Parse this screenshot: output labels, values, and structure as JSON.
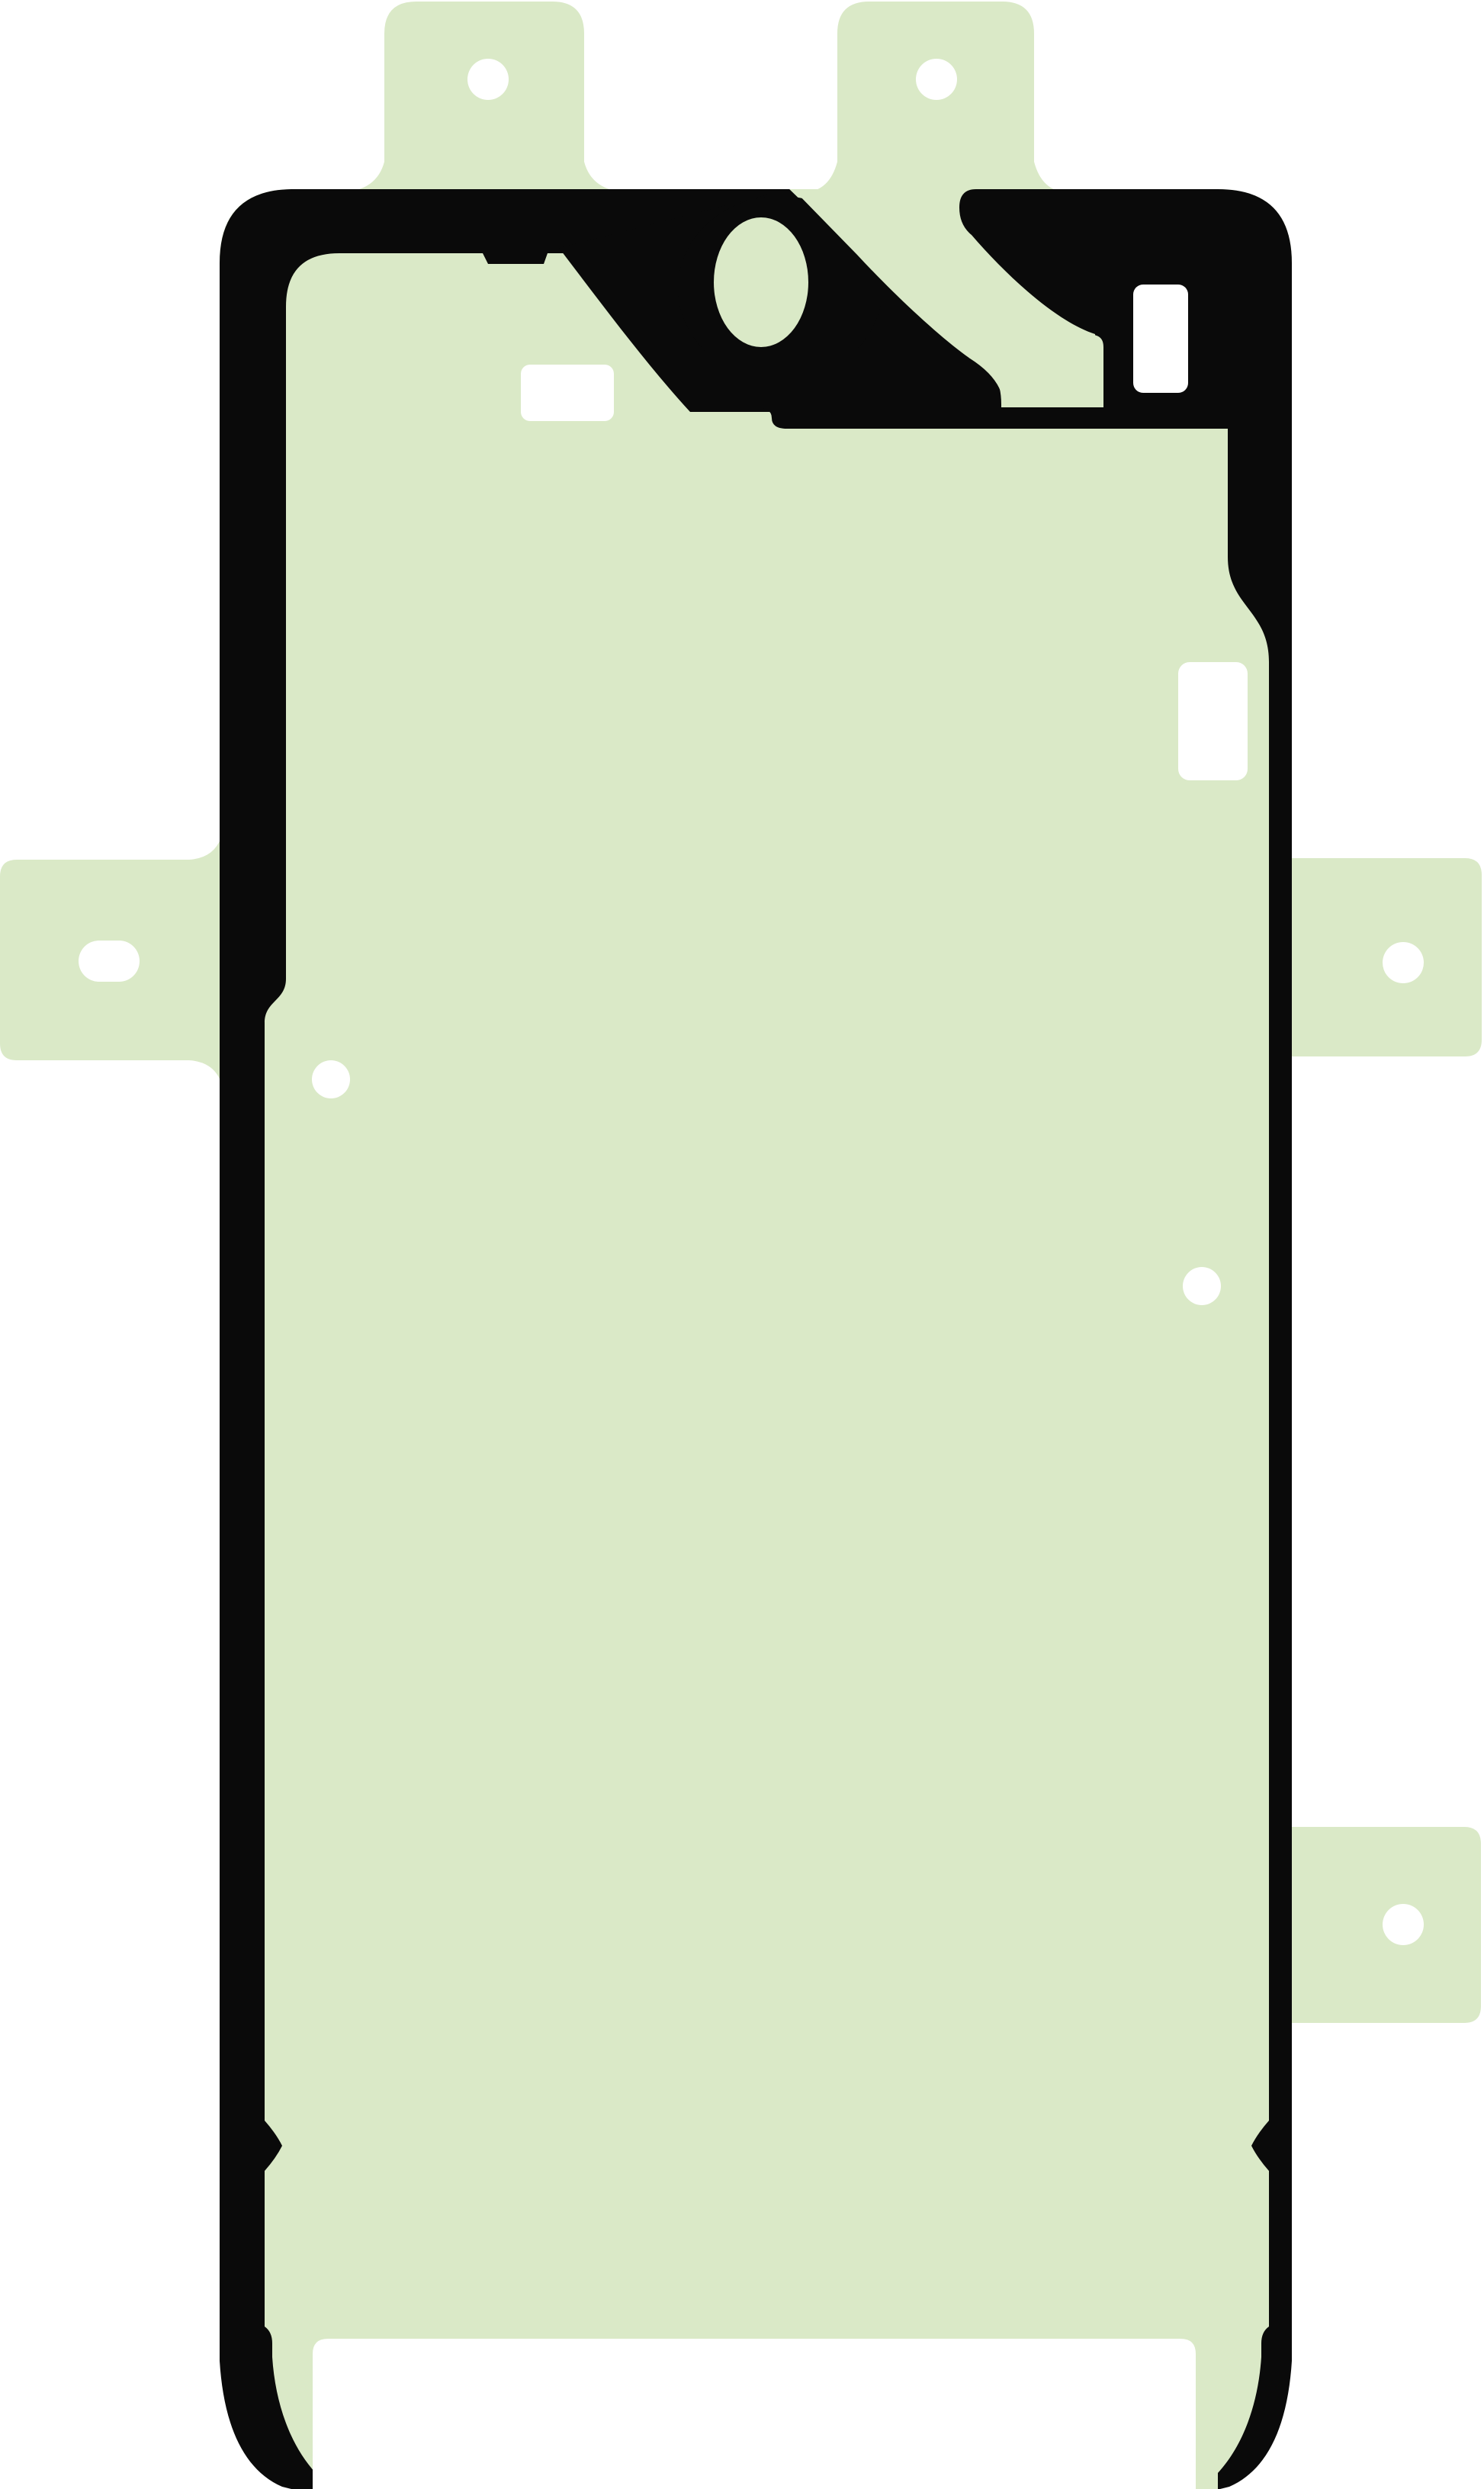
{
  "title": "Smartphone display adhesive sticker template",
  "colors": {
    "background": "#ffffff",
    "adhesive_green": "#dae9c7",
    "frame_black": "#0a0a0a",
    "cutout_white": "#ffffff"
  },
  "sheet": {
    "kind": "die-cut adhesive gasket, front view",
    "tabs": {
      "top_count": 2,
      "left_count": 1,
      "right_count": 2,
      "hole_shape_top": "circle",
      "hole_shape_left": "pill",
      "hole_shape_right": "circle"
    },
    "features": {
      "camera_ring": "black ring with oval green hole, top center-left",
      "diagonal_stripe": "black stripe from top band to under-camera band",
      "window_cutouts": 3,
      "alignment_dots": 2,
      "bottom_release_cutout": "white rounded opening at bottom center",
      "rail_pinch_spikes": "inner pointed pinches on both side rails near bottom",
      "rail_tapers": "both side rails taper to points at the bottom edge"
    }
  }
}
